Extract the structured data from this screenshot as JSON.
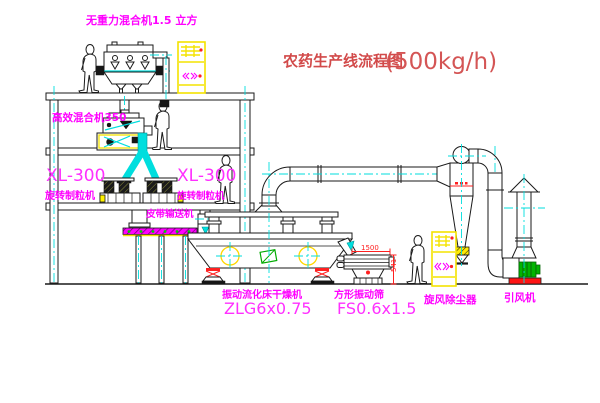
{
  "title": {
    "name": "农药生产线流程图",
    "capacity": "(500kg/h)"
  },
  "equipment": {
    "gravity_mixer": {
      "label": "无重力混合机1.5 立方"
    },
    "high_efficiency_mixer": {
      "label": "高效混合机350"
    },
    "granulator_left": {
      "model": "XL-300",
      "name": "旋转制粒机"
    },
    "granulator_right": {
      "model": "XL-300",
      "name": "旋转制粒机"
    },
    "belt_conveyor": {
      "name": "皮带输送机"
    },
    "fluid_bed_dryer": {
      "name": "振动流化床干燥机",
      "model": "ZLG6x0.75"
    },
    "vibrating_screen": {
      "name": "方形振动筛",
      "model": "FS0.6x1.5",
      "dim_length": "1500",
      "dim_height": "541"
    },
    "cyclone": {
      "name": "旋风除尘器"
    },
    "fan": {
      "name": "引风机"
    }
  },
  "colors": {
    "background": "#ffffff",
    "line": "#1a1a1a",
    "label_magenta": "#ff00ff",
    "title_red": "#d24a4a",
    "dimension_red": "#ff2020",
    "centerline_cyan": "#00dede",
    "accent_yellow": "#fff200",
    "motor_green": "#00b400"
  }
}
